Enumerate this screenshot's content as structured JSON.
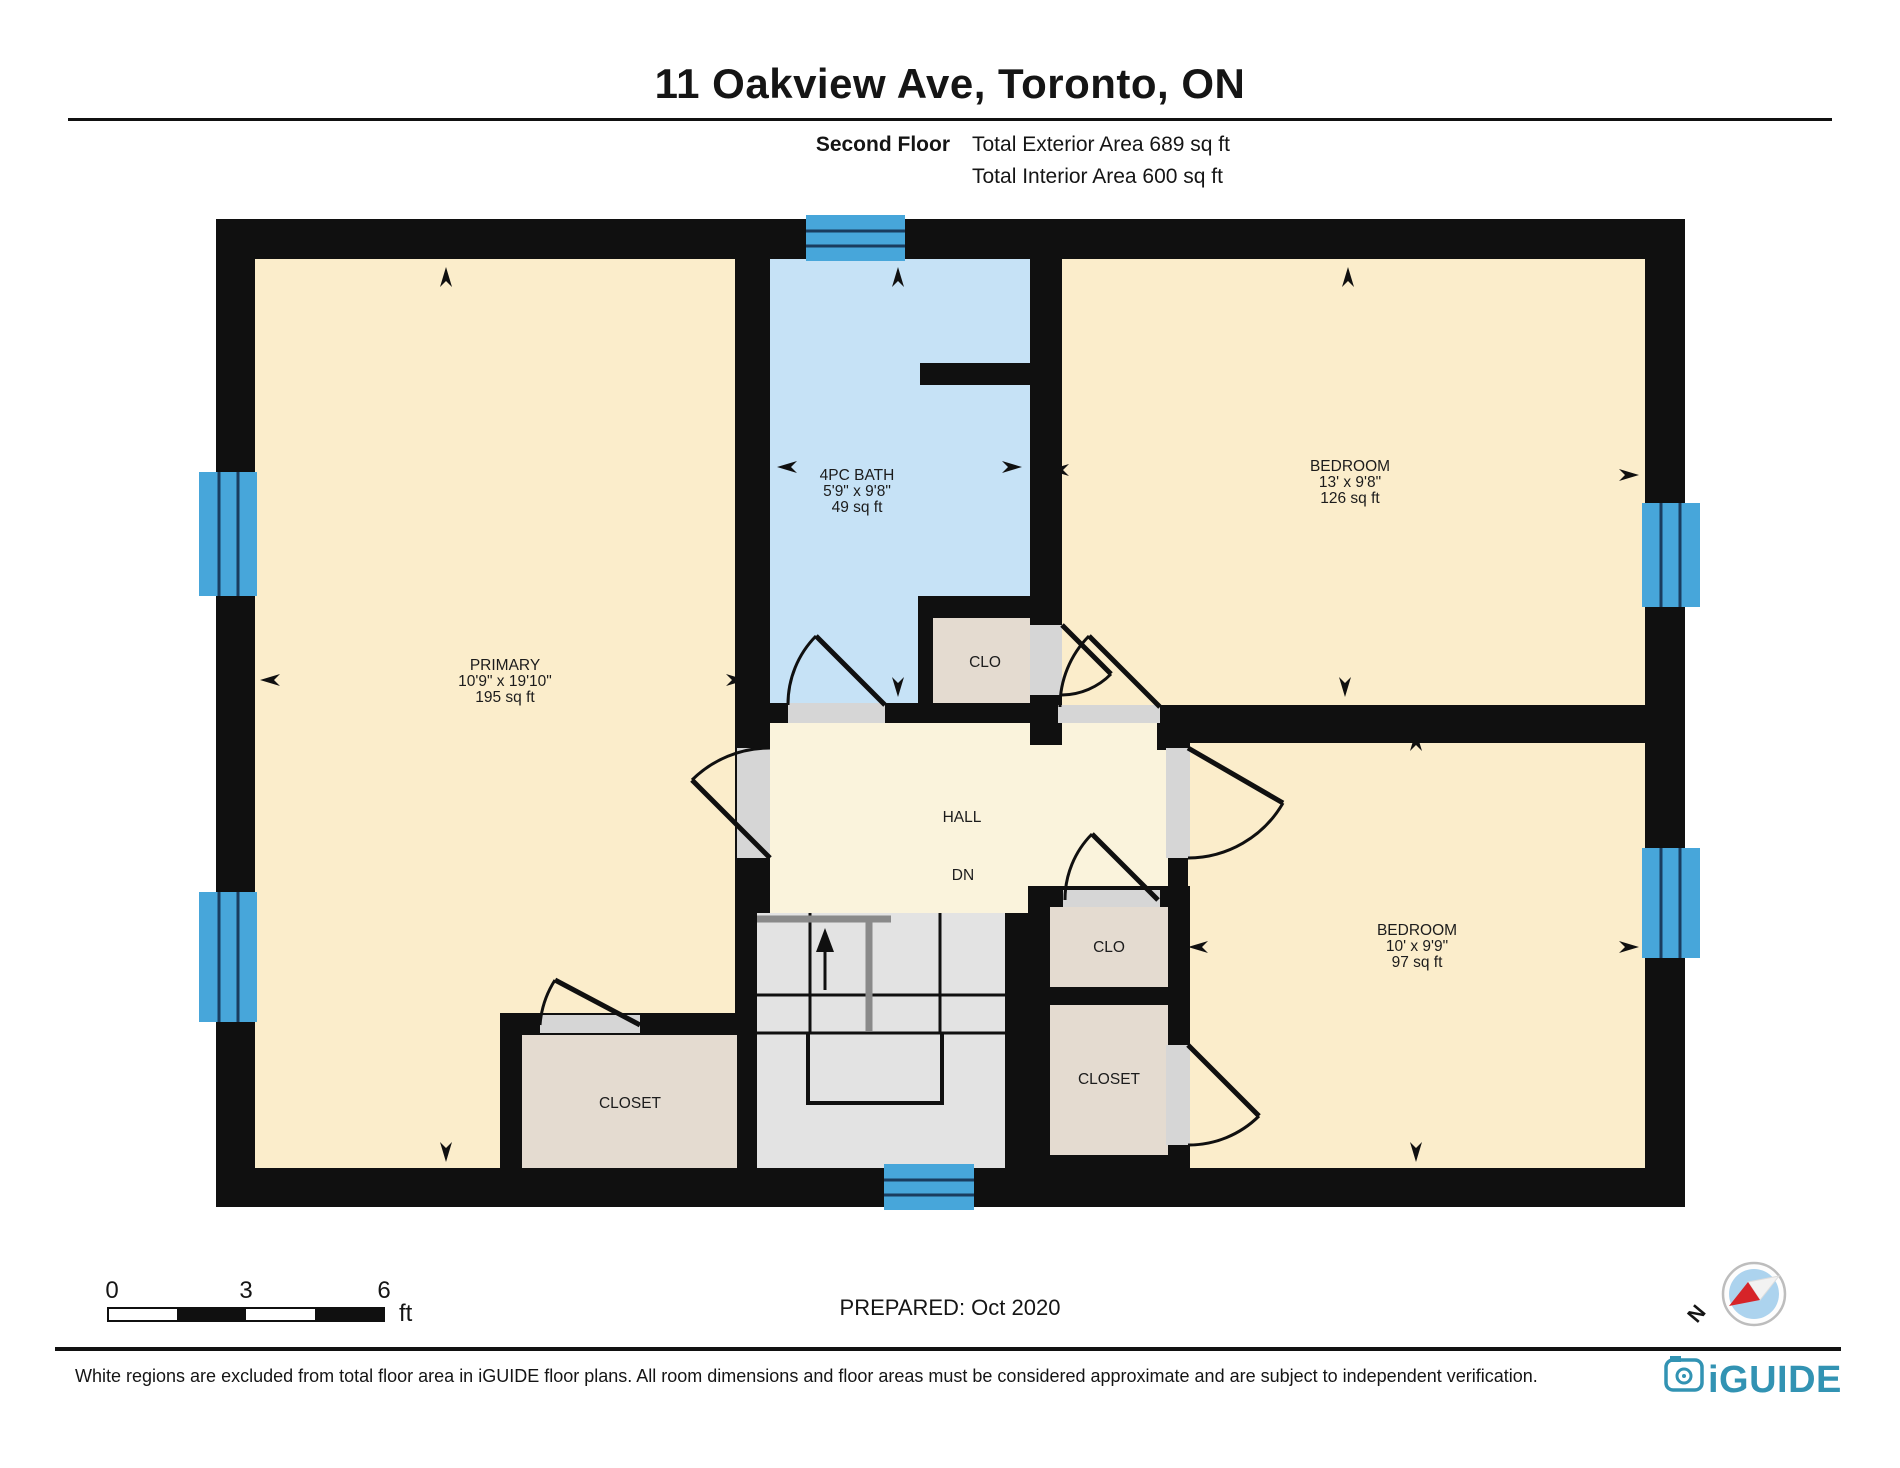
{
  "header": {
    "title": "11 Oakview Ave, Toronto, ON",
    "floor_label": "Second Floor",
    "exterior_area_label": "Total Exterior Area 689 sq ft",
    "interior_area_label": "Total Interior Area 600 sq ft"
  },
  "rooms": {
    "primary": {
      "name": "PRIMARY",
      "dims": "10'9\" x 19'10\"",
      "area": "195 sq ft"
    },
    "bath": {
      "name": "4PC BATH",
      "dims": "5'9\" x 9'8\"",
      "area": "49 sq ft"
    },
    "bedroom_top_right": {
      "name": "BEDROOM",
      "dims": "13' x 9'8\"",
      "area": "126 sq ft"
    },
    "bedroom_bottom_right": {
      "name": "BEDROOM",
      "dims": "10' x 9'9\"",
      "area": "97 sq ft"
    },
    "hall": {
      "name": "HALL",
      "stairs_label": "DN"
    },
    "closet_bedroom_top": {
      "name": "CLO"
    },
    "closet_hall": {
      "name": "CLO"
    },
    "closet_bedroom_bottom": {
      "name": "CLOSET"
    },
    "closet_primary": {
      "name": "CLOSET"
    }
  },
  "scale_bar": {
    "ticks": [
      "0",
      "3",
      "6"
    ],
    "unit": "ft"
  },
  "prepared_label": "PREPARED: Oct 2020",
  "compass": {
    "north_label": "N"
  },
  "footer": {
    "disclaimer": "White regions are excluded from total floor area in iGUIDE floor plans. All room dimensions and floor areas must be considered approximate and are subject to independent verification.",
    "brand": "iGUIDE"
  },
  "colors": {
    "wall": "#101010",
    "room_fill": "#FBEDCB",
    "hall_fill": "#FAF3DC",
    "bath_fill": "#C6E2F6",
    "closet_fill": "#E4DBD0",
    "stairs_fill": "#E3E3E3",
    "threshold": "#D6D6D6",
    "window_fill": "#47A6DA",
    "window_line": "#1A3C5E",
    "brand_teal": "#3293B3",
    "compass_red": "#D62429",
    "compass_blue": "#ACD3EE"
  }
}
